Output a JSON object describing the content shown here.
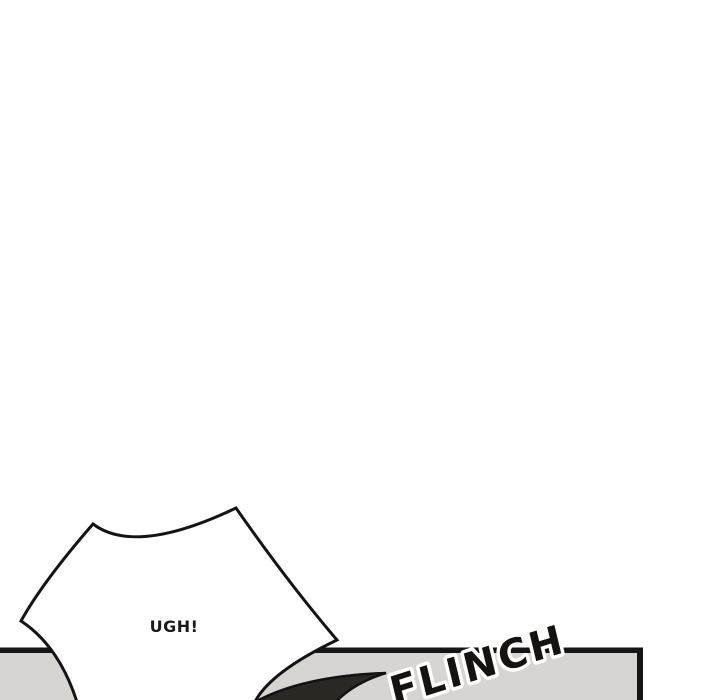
{
  "page": {
    "bg_color": "#ffffff"
  },
  "speech_bubble": {
    "text": "UGH!",
    "fill": "#ffffff",
    "stroke_color": "#141414",
    "text_color": "#1a1a1a"
  },
  "panel": {
    "fill": "#d6d5d1",
    "border_color": "#151515"
  },
  "swoosh": {
    "fill": "#2b2723",
    "stroke_color": "#121212"
  },
  "sfx": {
    "text": "FLINCH",
    "fill": "#15120f",
    "outline_color": "#ffffff"
  }
}
